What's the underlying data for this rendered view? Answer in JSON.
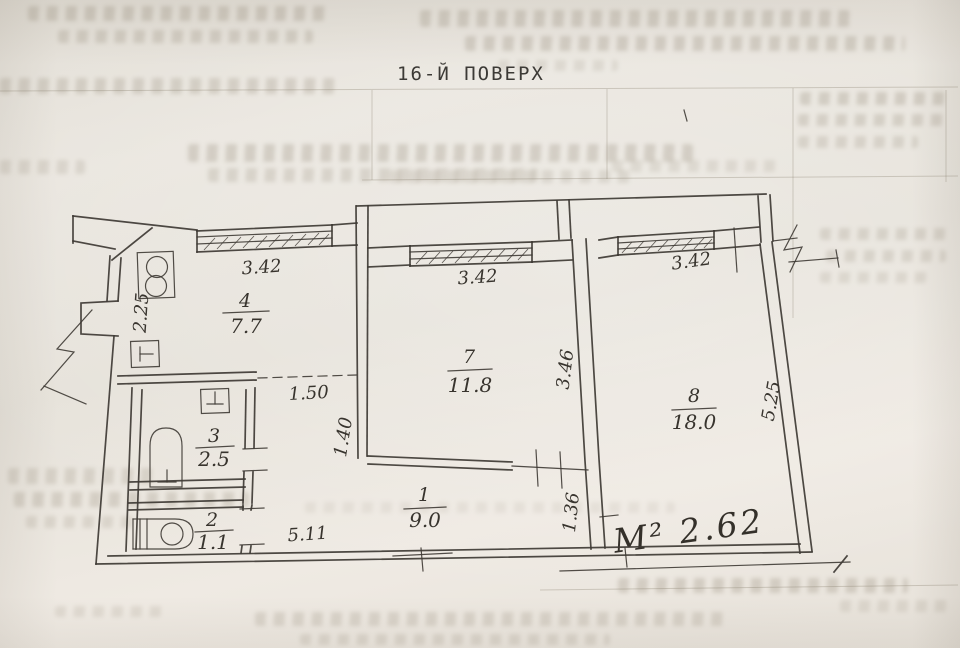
{
  "title": "16-Й ПОВЕРХ",
  "rooms": [
    {
      "number": "1",
      "area": "9.0"
    },
    {
      "number": "2",
      "area": "1.1"
    },
    {
      "number": "3",
      "area": "2.5"
    },
    {
      "number": "4",
      "area": "7.7"
    },
    {
      "number": "7",
      "area": "11.8"
    },
    {
      "number": "8",
      "area": "18.0"
    }
  ],
  "dimensions": {
    "kitchen_window": "3.42",
    "kitchen_side": "2.25",
    "passage_dashed": "1.50",
    "room7_window": "3.42",
    "room7_left_wall": "1.40",
    "room7_right_wall": "3.46",
    "room8_window": "3.42",
    "room8_right_wall": "5.25",
    "hall_bottom": "5.11",
    "hall_room8_wall": "1.36"
  },
  "annotations": {
    "handwritten_note": "М² 2.62"
  },
  "colors": {
    "paper": "#eae6df",
    "ink": "#3e3a34",
    "faint_ink": "#a89e8c"
  }
}
